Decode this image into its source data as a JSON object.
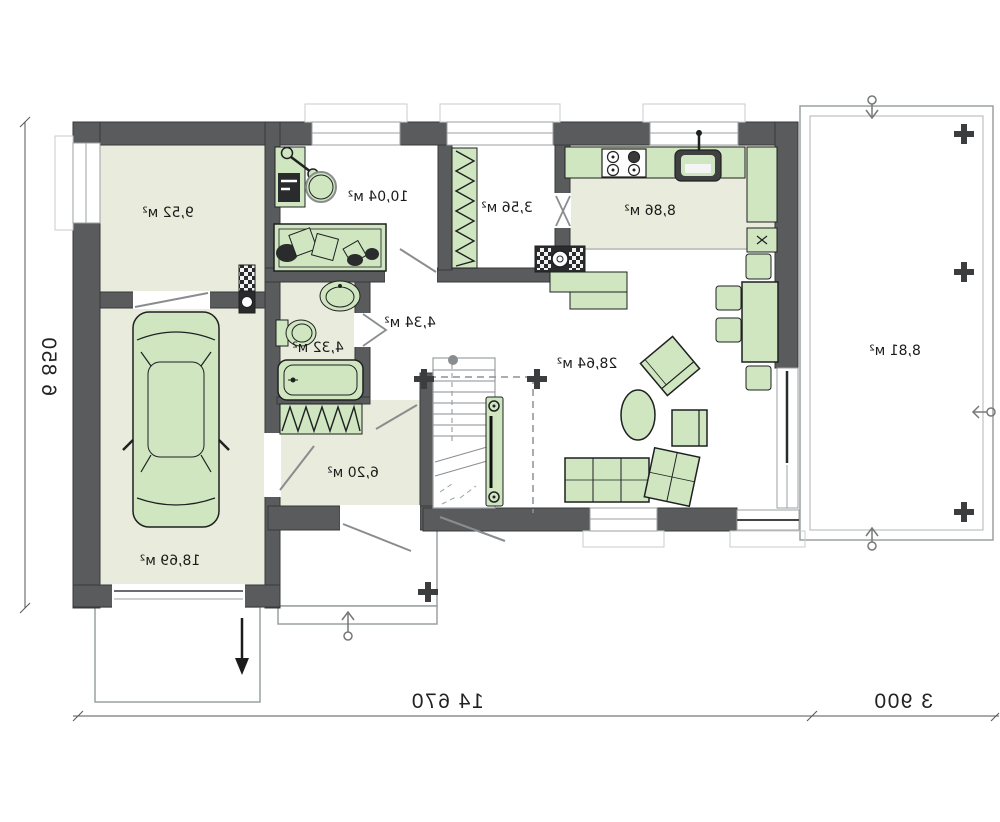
{
  "plan": {
    "type": "floor-plan",
    "note": "mirrored architectural drawing",
    "rooms": [
      {
        "id": "utility-room",
        "label": "9,52 м²"
      },
      {
        "id": "garage",
        "label": "18,69 м²"
      },
      {
        "id": "room-top",
        "label": "10,04 м²"
      },
      {
        "id": "pantry",
        "label": "3,56 м²"
      },
      {
        "id": "kitchen",
        "label": "8,86 м²"
      },
      {
        "id": "corridor",
        "label": "4,34 м²"
      },
      {
        "id": "bathroom",
        "label": "4,32 м²"
      },
      {
        "id": "hall",
        "label": "6,20 м²"
      },
      {
        "id": "living-room",
        "label": "28,64 м²"
      },
      {
        "id": "terrace",
        "label": "8,81 м²"
      }
    ],
    "dimensions": {
      "left": "6 850",
      "bottom_main": "14 670",
      "bottom_terrace": "3 900"
    },
    "colors": {
      "wall": "#595b5d",
      "floor": "#e9ebdc",
      "furniture": "#cfe6c1",
      "outline": "#9aa0a2"
    }
  }
}
